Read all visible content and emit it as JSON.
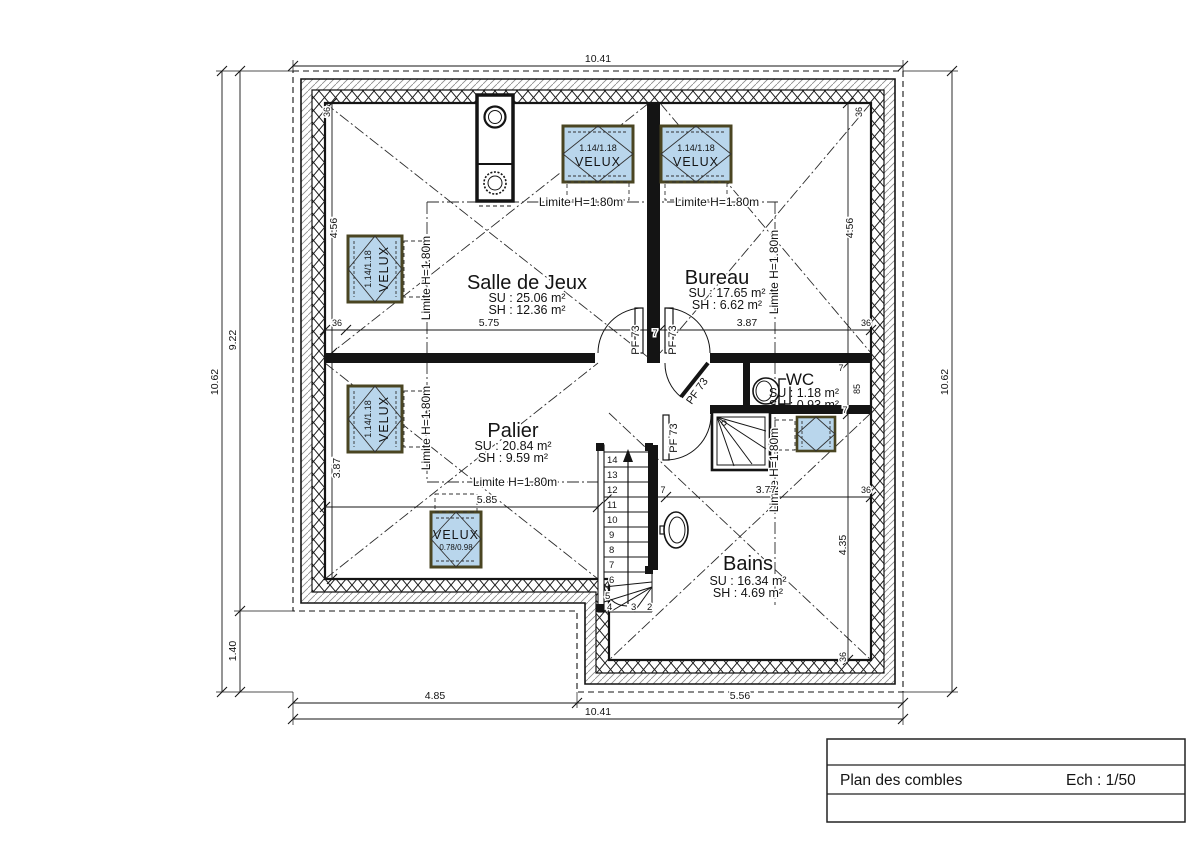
{
  "title_block": {
    "title": "Plan des combles",
    "scale": "Ech : 1/50"
  },
  "rooms": {
    "salle_de_jeux": {
      "name": "Salle de Jeux",
      "su": "SU : 25.06 m²",
      "sh": "SH : 12.36 m²"
    },
    "bureau": {
      "name": "Bureau",
      "su": "SU : 17.65 m²",
      "sh": "SH : 6.62 m²"
    },
    "palier": {
      "name": "Palier",
      "su": "SU : 20.84 m²",
      "sh": "SH : 9.59 m²"
    },
    "wc": {
      "name": "WC",
      "su": "SU : 1.18 m²",
      "sh": "SH : 0.93 m²"
    },
    "bains": {
      "name": "Bains",
      "su": "SU : 16.34 m²",
      "sh": "SH : 4.69 m²"
    }
  },
  "labels": {
    "limite": "Limite H=1.80m",
    "door_pf": "PF 73",
    "velux": "VELUX",
    "velux_size_large": "1.14/1.18",
    "velux_size_small": "0.78/0.98"
  },
  "dimensions": {
    "top_total": "10.41",
    "bottom_left": "4.85",
    "bottom_right": "5.56",
    "bottom_total": "10.41",
    "left_upper": "9.22",
    "left_lower": "1.40",
    "left_total": "10.62",
    "right_total": "10.62",
    "interior": {
      "h1": [
        "36",
        "5.75",
        "7",
        "3.87",
        "36"
      ],
      "h2": [
        "5.85",
        "7",
        "3.77",
        "36"
      ],
      "v_left": [
        "36",
        "4.56",
        "3.87"
      ],
      "v_right": [
        "36",
        "4.56",
        "7",
        "85",
        "7",
        "4.35",
        "36"
      ]
    }
  },
  "stairs": {
    "steps": [
      "14",
      "13",
      "12",
      "11",
      "10",
      "9",
      "8",
      "7",
      "6",
      "5",
      "4",
      "3",
      "2"
    ]
  },
  "colors": {
    "velux_fill": "#b9d6ec",
    "velux_border": "#4a4522",
    "line": "#141414"
  }
}
